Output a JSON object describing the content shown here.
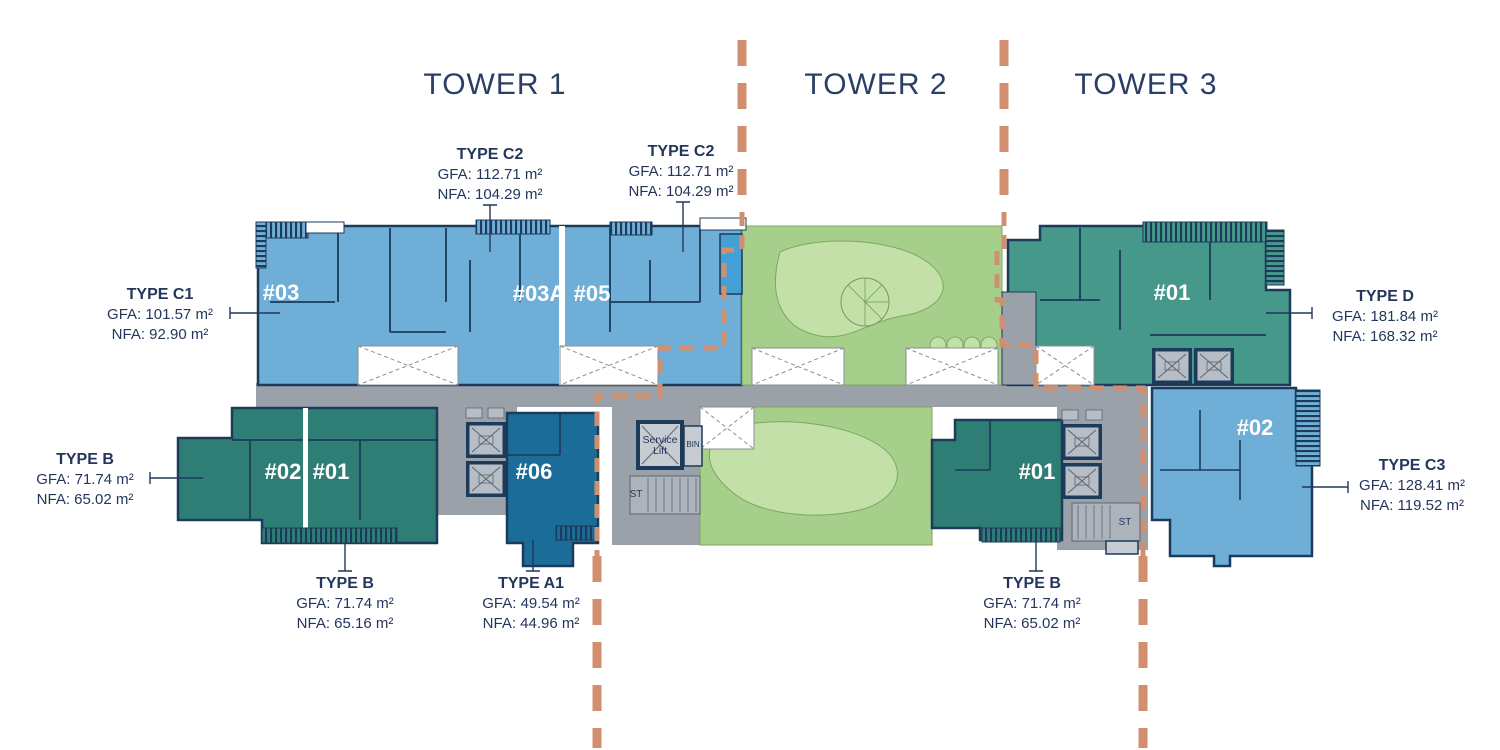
{
  "towers": [
    {
      "label": "TOWER 1"
    },
    {
      "label": "TOWER 2"
    },
    {
      "label": "TOWER 3"
    }
  ],
  "unit_types": [
    {
      "id": "type-c2-left",
      "name": "TYPE C2",
      "gfa": "GFA: 112.71 m²",
      "nfa": "NFA: 104.29 m²"
    },
    {
      "id": "type-c2-right",
      "name": "TYPE C2",
      "gfa": "GFA: 112.71 m²",
      "nfa": "NFA: 104.29 m²"
    },
    {
      "id": "type-c1",
      "name": "TYPE C1",
      "gfa": "GFA: 101.57 m²",
      "nfa": "NFA: 92.90 m²"
    },
    {
      "id": "type-b-left",
      "name": "TYPE B",
      "gfa": "GFA: 71.74 m²",
      "nfa": "NFA: 65.02 m²"
    },
    {
      "id": "type-d",
      "name": "TYPE D",
      "gfa": "GFA: 181.84 m²",
      "nfa": "NFA: 168.32 m²"
    },
    {
      "id": "type-c3",
      "name": "TYPE C3",
      "gfa": "GFA: 128.41 m²",
      "nfa": "NFA: 119.52 m²"
    },
    {
      "id": "type-b-bottom-left",
      "name": "TYPE B",
      "gfa": "GFA: 71.74 m²",
      "nfa": "NFA: 65.16 m²"
    },
    {
      "id": "type-a1",
      "name": "TYPE A1",
      "gfa": "GFA: 49.54 m²",
      "nfa": "NFA: 44.96 m²"
    },
    {
      "id": "type-b-bottom-right",
      "name": "TYPE B",
      "gfa": "GFA: 71.74 m²",
      "nfa": "NFA: 65.02 m²"
    }
  ],
  "units": {
    "t1_03": "#03",
    "t1_03a": "#03A",
    "t1_05": "#05",
    "t1_02": "#02",
    "t1_01": "#01",
    "t1_06": "#06",
    "t2_01": "#01",
    "t3_01": "#01",
    "t3_02": "#02"
  },
  "core_labels": {
    "service_lift": "Service Lift",
    "bin": "BIN",
    "st_left": "ST",
    "st_right": "ST"
  },
  "colors": {
    "text_navy": "#24365C",
    "wall_navy": "#1C3A5A",
    "unit_blue": "#6FAED7",
    "unit_dark_blue": "#1B6C98",
    "unit_teal_dark": "#2E7E76",
    "unit_teal": "#45988A",
    "landscape_green": "#A6CF8B",
    "landscape_path_green": "#C4E0A9",
    "pool_blue": "#45A0D6",
    "corridor_gray": "#9BA1A8",
    "shaft_gray": "#B7BDC5",
    "tower_divider_salmon": "#D28F6F"
  }
}
